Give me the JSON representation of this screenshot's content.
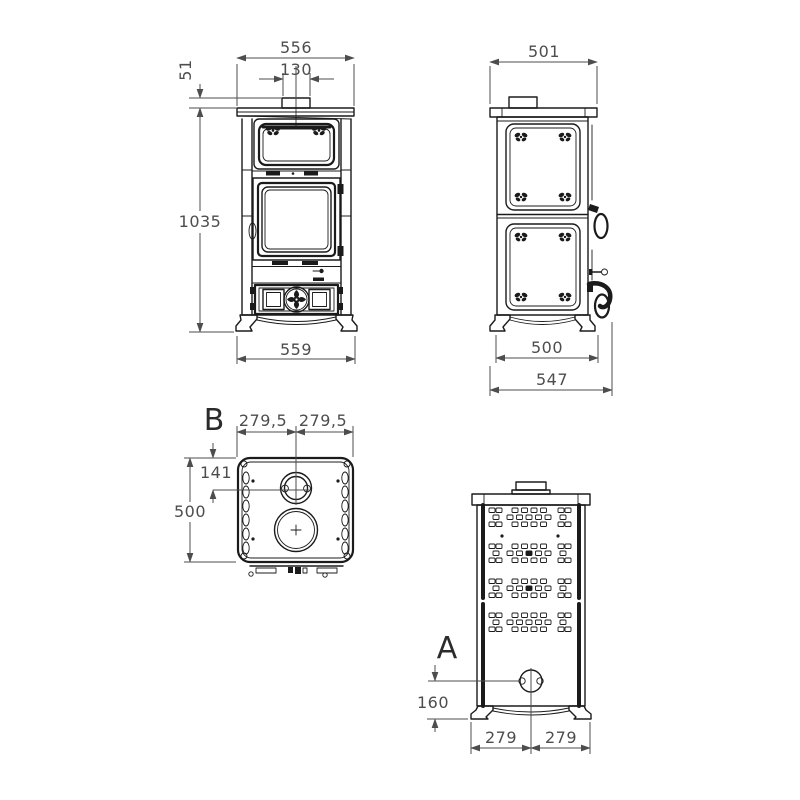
{
  "meta": {
    "drawing_title": "stove-technical-drawing",
    "background": "#ffffff",
    "object_line_color": "#1b1b1b",
    "dimension_color": "#4d4d4d"
  },
  "views": {
    "front": {
      "dim_top_width": "556",
      "dim_flue_width": "130",
      "dim_flue_height": "51",
      "dim_height": "1035",
      "dim_base_width": "559"
    },
    "side": {
      "dim_top_depth": "501",
      "dim_base_depth": "500",
      "dim_total_depth": "547"
    },
    "top": {
      "section_label": "B",
      "dim_half_left": "279,5",
      "dim_half_right": "279,5",
      "dim_flue_offset": "141",
      "dim_depth": "500"
    },
    "rear": {
      "section_label": "A",
      "dim_inlet_height": "160",
      "dim_half_left": "279",
      "dim_half_right": "279"
    }
  }
}
